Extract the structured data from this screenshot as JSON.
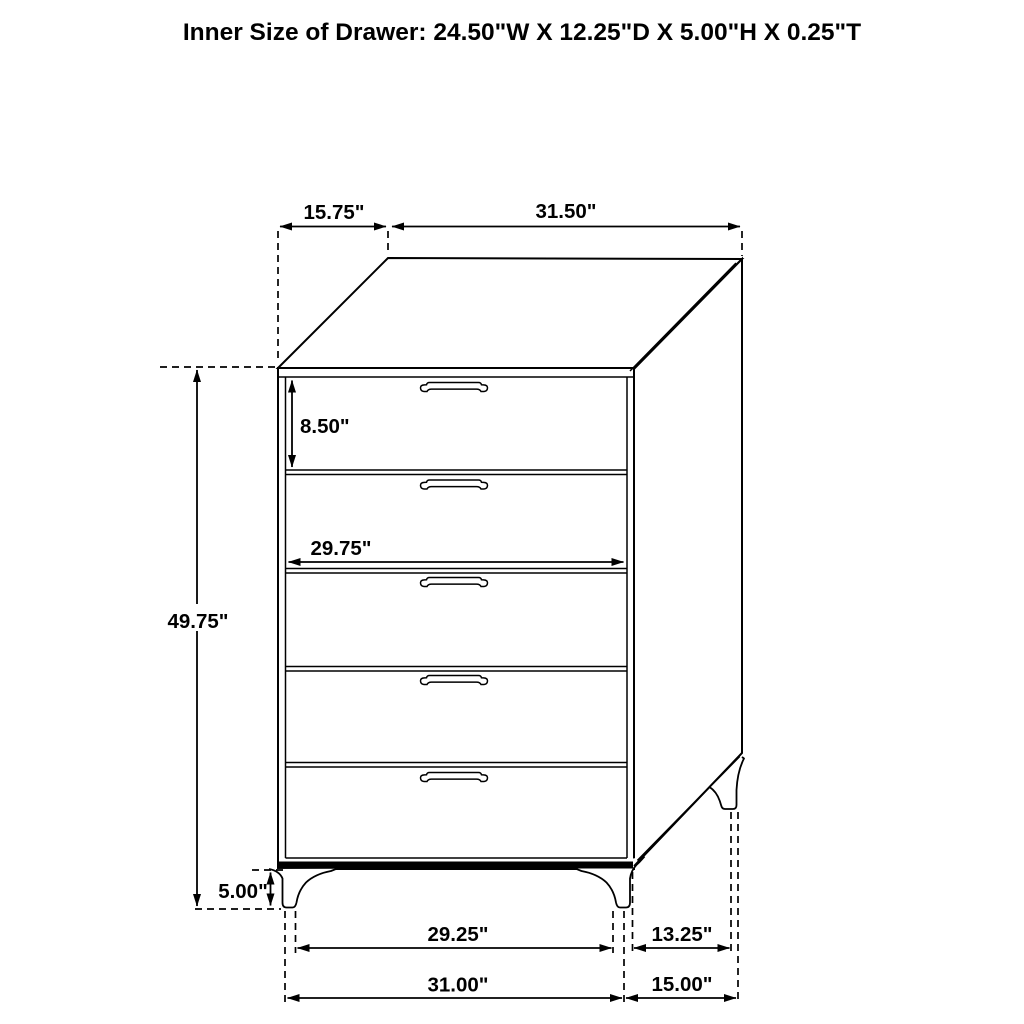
{
  "title": "Inner Size of Drawer: 24.50\"W X 12.25\"D X 5.00\"H X 0.25\"T",
  "figure": {
    "kind": "furniture dimension drawing",
    "item": "5-drawer chest",
    "drawer_count": 5
  },
  "dimensions": {
    "top_depth": "15.75\"",
    "top_width": "31.50\"",
    "top_drawer_height": "8.50\"",
    "drawer_front_width": "29.75\"",
    "overall_height": "49.75\"",
    "leg_height": "5.00\"",
    "front_feet_inner_span": "29.25\"",
    "front_base_width": "31.00\"",
    "side_feet_inner_span": "13.25\"",
    "side_base_depth": "15.00\""
  },
  "colors": {
    "line": "#000000",
    "text": "#000000",
    "background": "#ffffff"
  }
}
